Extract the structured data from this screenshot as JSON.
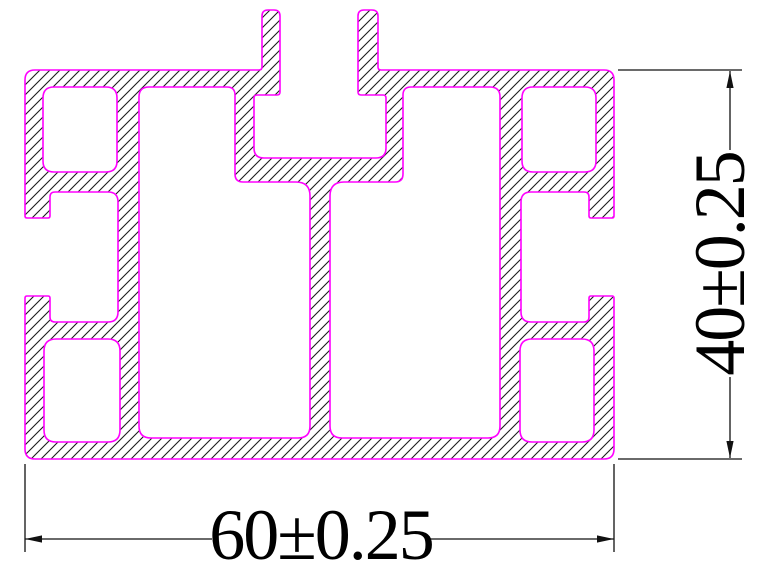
{
  "drawing": {
    "title": "aluminum-extrusion-profile-cross-section",
    "background": "#ffffff",
    "outline_color": "#ff00ff",
    "hatch": {
      "color": "#1c1c1c",
      "spacing": 10,
      "direction": "forward-slash-45deg",
      "line_width": 1.1
    },
    "dimension_style": {
      "color": "#111111",
      "line_width": 1.3,
      "font_size": 72,
      "arrow_length": 17,
      "arrow_half_width": 3.6
    },
    "profile": {
      "outer": {
        "points": [
          [
            25,
            70
          ],
          [
            262,
            70
          ],
          [
            262,
            10
          ],
          [
            280,
            10
          ],
          [
            280,
            95
          ],
          [
            254,
            95
          ],
          [
            254,
            158
          ],
          [
            386,
            158
          ],
          [
            386,
            95
          ],
          [
            358,
            95
          ],
          [
            358,
            10
          ],
          [
            378,
            10
          ],
          [
            378,
            70
          ],
          [
            614,
            70
          ],
          [
            614,
            218
          ],
          [
            589,
            218
          ],
          [
            589,
            192
          ],
          [
            521,
            192
          ],
          [
            521,
            322
          ],
          [
            589,
            322
          ],
          [
            589,
            296
          ],
          [
            614,
            296
          ],
          [
            614,
            459
          ],
          [
            25,
            459
          ],
          [
            25,
            296
          ],
          [
            50,
            296
          ],
          [
            50,
            322
          ],
          [
            118,
            322
          ],
          [
            118,
            192
          ],
          [
            50,
            192
          ],
          [
            50,
            218
          ],
          [
            25,
            218
          ]
        ],
        "radii": [
          10,
          3,
          6,
          6,
          3,
          3,
          10,
          10,
          3,
          3,
          6,
          6,
          3,
          10,
          2,
          2,
          5,
          10,
          10,
          5,
          2,
          2,
          10,
          10,
          2,
          2,
          5,
          10,
          10,
          5,
          2,
          2
        ]
      },
      "holes": [
        {
          "name": "top-left-corner-cavity",
          "rect": [
            43,
            87,
            74,
            85
          ],
          "r": 11
        },
        {
          "name": "top-right-corner-cavity",
          "rect": [
            522,
            87,
            74,
            85
          ],
          "r": 11
        },
        {
          "name": "bottom-left-corner-cavity",
          "rect": [
            44,
            339,
            76,
            103
          ],
          "r": 12
        },
        {
          "name": "bottom-right-corner-cavity",
          "rect": [
            520,
            339,
            74,
            103
          ],
          "r": 12
        },
        {
          "name": "left-main-cavity",
          "points": [
            [
              139,
              87
            ],
            [
              235,
              87
            ],
            [
              235,
              182
            ],
            [
              310,
              182
            ],
            [
              310,
              438
            ],
            [
              139,
              438
            ]
          ],
          "radii": [
            10,
            8,
            8,
            14,
            12,
            12
          ]
        },
        {
          "name": "right-main-cavity",
          "points": [
            [
              403,
              87
            ],
            [
              500,
              87
            ],
            [
              500,
              438
            ],
            [
              330,
              438
            ],
            [
              330,
              182
            ],
            [
              403,
              182
            ]
          ],
          "radii": [
            8,
            10,
            12,
            12,
            14,
            8
          ]
        }
      ]
    },
    "dimensions": [
      {
        "name": "overall-width",
        "label": "60±0.25",
        "orientation": "horizontal",
        "ext_lines": [
          [
            25,
            464,
            25,
            552
          ],
          [
            614,
            464,
            614,
            552
          ]
        ],
        "line_segments": [
          [
            25,
            539,
            212,
            539
          ],
          [
            430,
            539,
            614,
            539
          ]
        ],
        "arrows": [
          {
            "tip": [
              25,
              539
            ],
            "dir": "left"
          },
          {
            "tip": [
              614,
              539
            ],
            "dir": "right"
          }
        ],
        "label_pos": [
          321,
          559
        ]
      },
      {
        "name": "overall-height",
        "label": "40±0.25",
        "orientation": "vertical",
        "ext_lines": [
          [
            618,
            70,
            742,
            70
          ],
          [
            618,
            459,
            742,
            459
          ]
        ],
        "line_segments": [
          [
            730,
            71,
            730,
            150
          ],
          [
            730,
            377,
            730,
            458
          ]
        ],
        "arrows": [
          {
            "tip": [
              730,
              71
            ],
            "dir": "up"
          },
          {
            "tip": [
              730,
              458
            ],
            "dir": "down"
          }
        ],
        "label_pos": [
          744,
          264
        ]
      }
    ]
  }
}
